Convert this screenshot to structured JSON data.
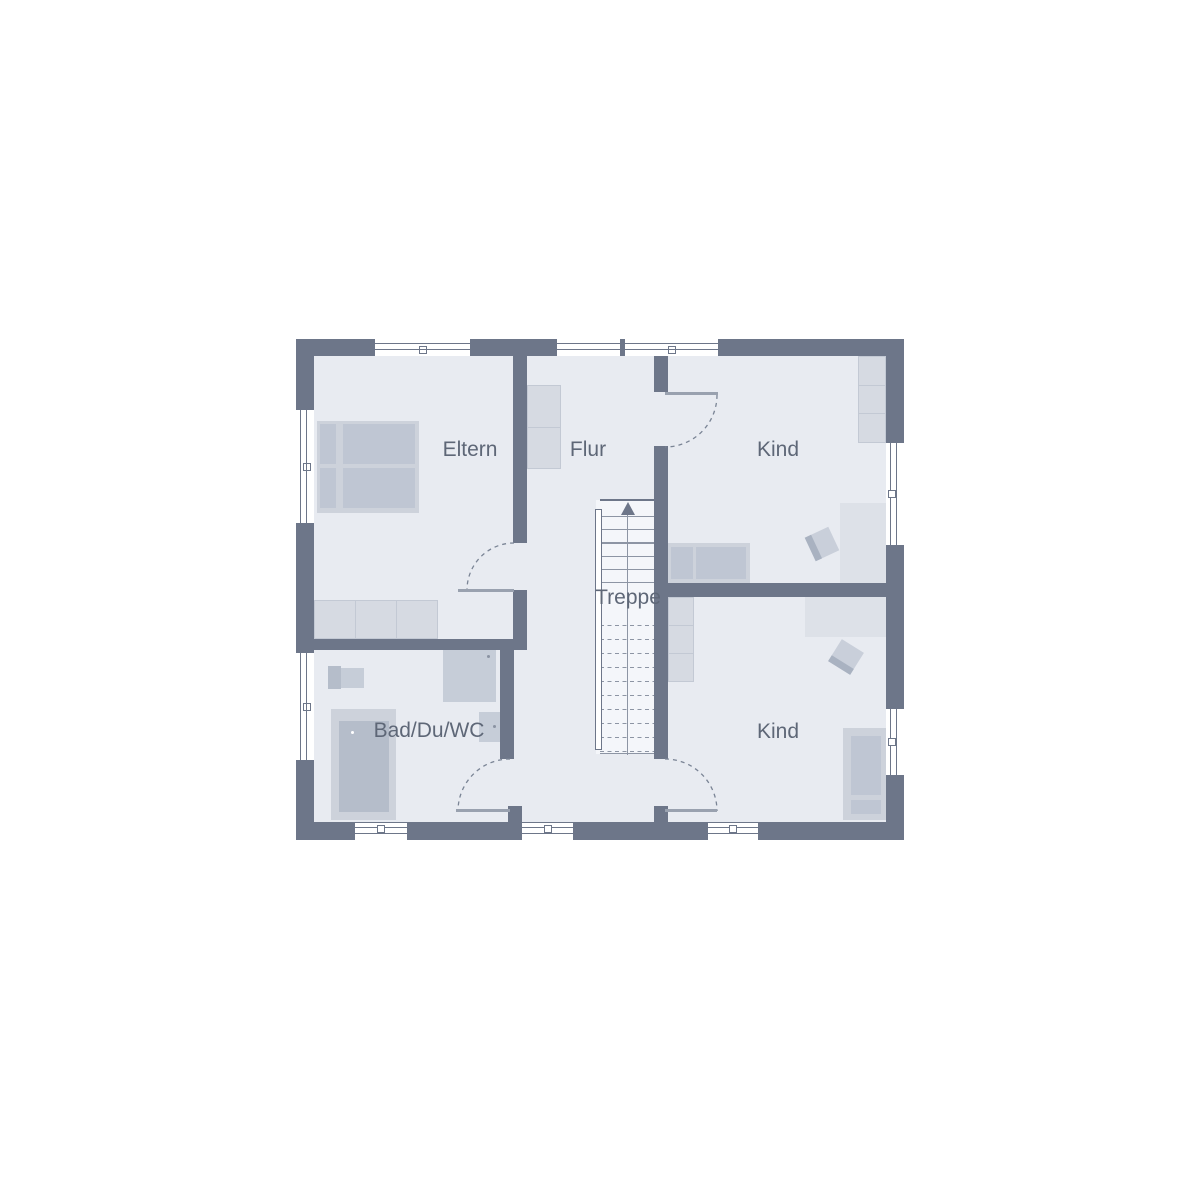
{
  "plan": {
    "type": "floor-plan-upper-storey",
    "labels": {
      "eltern": "Eltern",
      "flur": "Flur",
      "kind_top": "Kind",
      "kind_bottom": "Kind",
      "bad": "Bad/Du/WC",
      "treppe": "Treppe"
    },
    "stairs": {
      "direction_icon": "up-arrow",
      "solid_treads": 6,
      "dashed_treads": 10
    },
    "colors": {
      "wall": "#6d7689",
      "floor": "#e8ebf1",
      "stair_floor": "#f4f6fa",
      "line": "#8d95a4",
      "text": "#5e6777",
      "furniture_light": "#d6dae2",
      "furniture_frame": "#cdd2db",
      "furniture_dark": "#bfc6d3",
      "fixture": "#c6cdd8",
      "fixture_dark": "#b5bdca",
      "desk": "#dde1e8",
      "window_fill": "#ffffff"
    }
  }
}
